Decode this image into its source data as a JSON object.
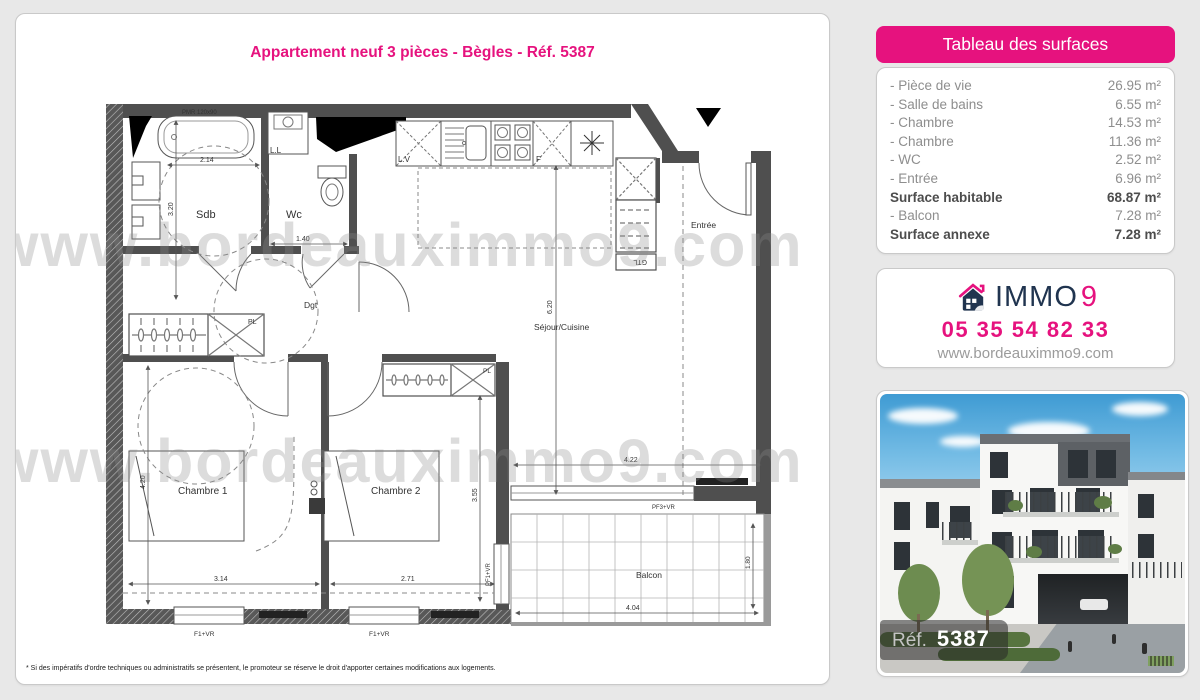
{
  "page": {
    "title": "Appartement neuf 3 pièces - Bègles - Réf. 5387",
    "disclaimer": "* Si des impératifs d'ordre techniques ou administratifs se présentent, le promoteur se réserve le droit d'apporter certaines modifications aux logements.",
    "watermark": "www.bordeauximmo9.com"
  },
  "surfaces": {
    "header": "Tableau des surfaces",
    "rows": [
      {
        "label": "- Pièce de vie",
        "value": "26.95 m²"
      },
      {
        "label": "- Salle de bains",
        "value": "6.55 m²"
      },
      {
        "label": "- Chambre",
        "value": "14.53 m²"
      },
      {
        "label": "- Chambre",
        "value": "11.36 m²"
      },
      {
        "label": "- WC",
        "value": "2.52 m²"
      },
      {
        "label": "- Entrée",
        "value": "6.96 m²"
      },
      {
        "label": "Surface habitable",
        "value": "68.87 m²"
      },
      {
        "label": "- Balcon",
        "value": "7.28 m²"
      },
      {
        "label": "Surface annexe",
        "value": "7.28 m²"
      }
    ]
  },
  "agency": {
    "brand_immo": "IMMO",
    "brand_9": "9",
    "phone": "05 35 54 82 33",
    "website": "www.bordeauximmo9.com"
  },
  "photo": {
    "ref_label": "Réf.",
    "ref_number": "5387"
  },
  "plan": {
    "rooms": {
      "sdb": "Sdb",
      "wc": "Wc",
      "dgt": "Dgt",
      "entree": "Entrée",
      "sejour": "Séjour/Cuisine",
      "chambre1": "Chambre 1",
      "chambre2": "Chambre 2",
      "balcon": "Balcon"
    },
    "fixtures": {
      "ll": "L.L",
      "lv": "L.V",
      "f": "F",
      "pl": "PL",
      "gtl": "GTL",
      "pmr": "PMR 120x90"
    },
    "dimensions": {
      "sdb_w": "2.14",
      "sdb_h": "3.20",
      "wc_w": "1.40",
      "sejour_h": "6.20",
      "sejour_w": "4.22",
      "ch1_h": "4.20",
      "ch1_w": "3.14",
      "ch2_w": "2.71",
      "ch2_h": "3.55",
      "balcon_w": "4.04",
      "balcon_d": "1.80"
    },
    "windows": {
      "ch1": "F1+VR",
      "ch2": "F1+VR",
      "sejour": "PF3+VR",
      "balcon_door": "PF1+VR"
    }
  },
  "colors": {
    "pink": "#e6127e",
    "navy": "#20344f",
    "wall": "#4f4f4f",
    "background": "#e8e8e8"
  }
}
